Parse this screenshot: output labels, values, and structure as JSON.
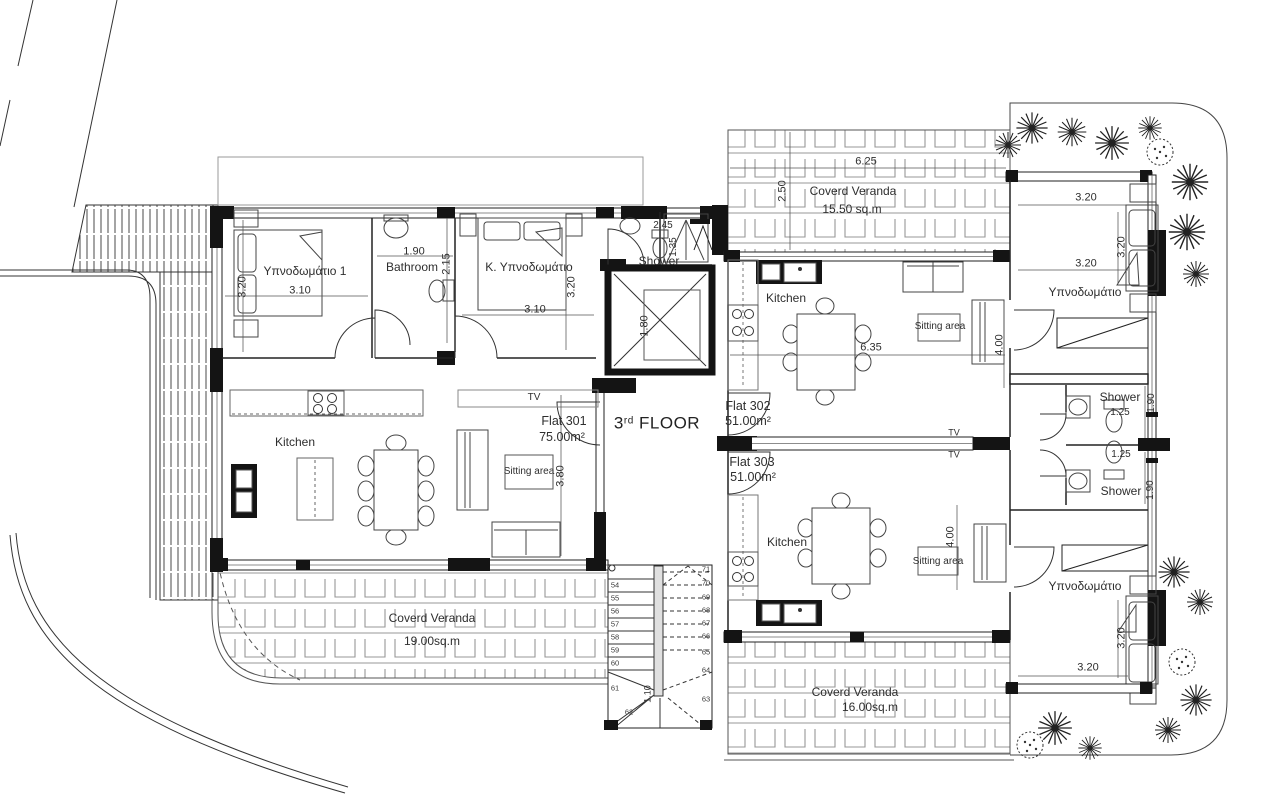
{
  "floor": {
    "number": "3",
    "ordinal": "rd",
    "word": "FLOOR"
  },
  "flats": {
    "f301": {
      "name": "Flat 301",
      "area": "75.00m²",
      "bedroom1": {
        "label": "Υπνοδωμάτιο 1",
        "w": "3.10",
        "h": "3.20"
      },
      "bathroom": {
        "label": "Bathroom",
        "w": "1.90",
        "h": "2.15"
      },
      "master": {
        "label": "Κ. Υπνοδωμάτιο",
        "w": "3.10",
        "h": "3.20"
      },
      "shower": {
        "label": "Shower",
        "w": "2.45",
        "h": "1.35"
      },
      "kitchen": "Kitchen",
      "sitting": "Sitting area",
      "tv": "TV",
      "living_h": "3.80"
    },
    "f302": {
      "name": "Flat 302",
      "area": "51.00m²",
      "kitchen": "Kitchen",
      "sitting": "Sitting area",
      "tv": "TV",
      "living_w": "6.35",
      "living_h": "4.00",
      "bedroom": {
        "label": "Υπνοδωμάτιο",
        "w": "3.20",
        "h": "3.20",
        "w2": "3.20"
      },
      "shower": {
        "label": "Shower",
        "w": "1.25",
        "h": "1.90"
      }
    },
    "f303": {
      "name": "Flat 303",
      "area": "51.00m²",
      "kitchen": "Kitchen",
      "sitting": "Sitting area",
      "tv": "TV",
      "living_h": "4.00",
      "bedroom": {
        "label": "Υπνοδωμάτιο",
        "w": "3.20",
        "h": "3.20"
      },
      "shower": {
        "label": "Shower",
        "w": "1.25",
        "h": "1.90"
      }
    }
  },
  "verandas": {
    "top": {
      "label": "Coverd Veranda",
      "area": "15.50 sq.m",
      "w": "6.25",
      "d": "2.50"
    },
    "left": {
      "label": "Coverd Veranda",
      "area": "19.00sq.m"
    },
    "bottom": {
      "label": "Coverd Veranda",
      "area": "16.00sq.m"
    }
  },
  "core": {
    "elevator_d": "1.80",
    "stair_w": "1.10",
    "steps_left": [
      "54",
      "55",
      "56",
      "57",
      "58",
      "59",
      "60",
      "61",
      "62"
    ],
    "steps_right": [
      "71",
      "70",
      "69",
      "68",
      "67",
      "66",
      "65",
      "64",
      "63"
    ]
  }
}
